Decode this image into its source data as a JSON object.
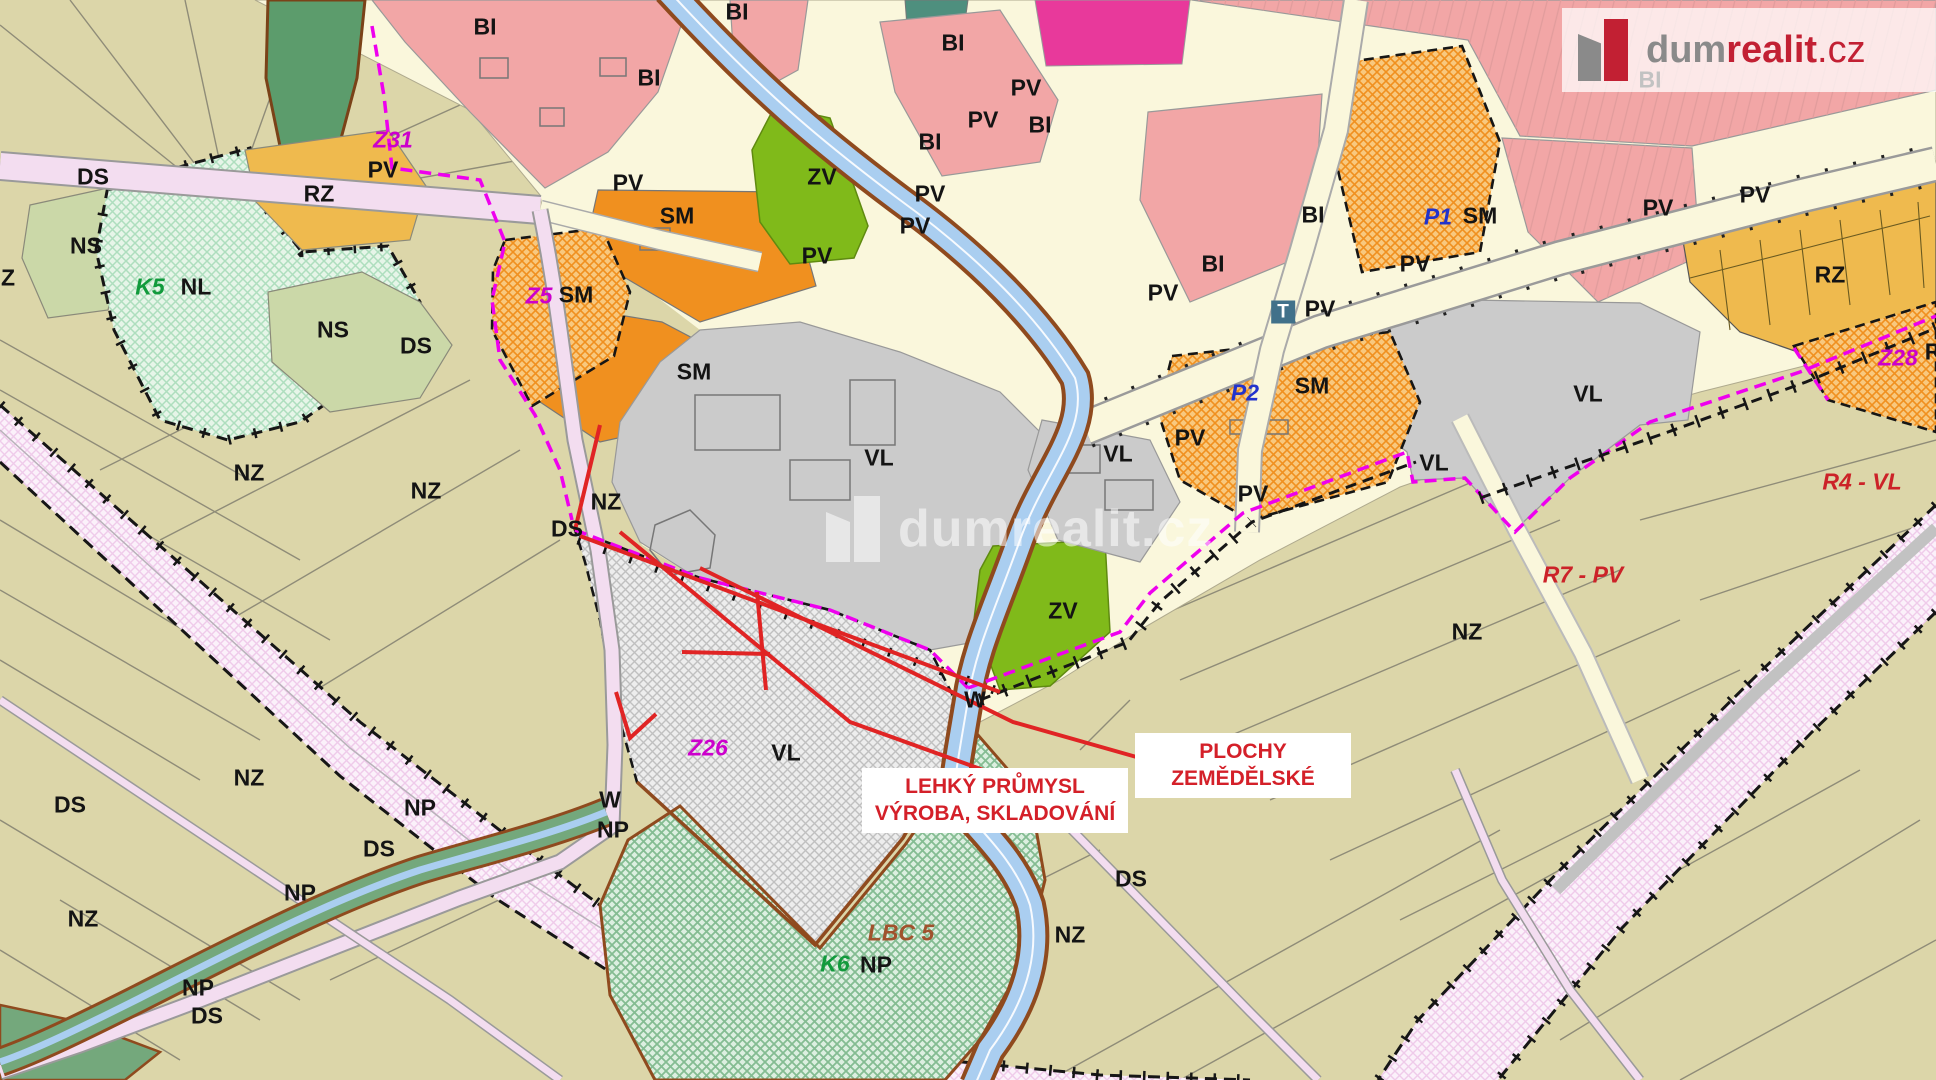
{
  "meta": {
    "title": "Územní plán - zoning map preview",
    "width": 1936,
    "height": 1080
  },
  "branding": {
    "logo_dum": "dum",
    "logo_realit": "realit",
    "logo_cz": ".cz",
    "watermark": "dumrealit.cz"
  },
  "annotations": {
    "industry": {
      "line1": "LEHKÝ PRŮMYSL",
      "line2": "VÝROBA, SKLADOVÁNÍ"
    },
    "agriculture": {
      "line1": "PLOCHY",
      "line2": "ZEMĚDĚLSKÉ"
    }
  },
  "colors": {
    "nz": "#DCD6A9",
    "cream": "#FAF7DC",
    "bi": "#F2A6A6",
    "magzone": "#E8399B",
    "sm": "#F0901F",
    "smhbg": "#F8C87E",
    "rz": "#EFBA4E",
    "zv": "#80BA1A",
    "vl": "#CBCBCB",
    "ns": "#CBD8A8",
    "np": "#74A87C",
    "dgreen": "#5C9C6C",
    "river": "#AACEF0",
    "bank": "#8F4A1E",
    "roadpink": "#F3DDF0",
    "dashm": "#EE00EE",
    "red": "#E02424",
    "redlabel": "#D42029",
    "brandgray": "#8A8A8A",
    "brandred": "#C22033"
  },
  "zone_labels": [
    {
      "t": "DS",
      "x": 93,
      "y": 177
    },
    {
      "t": "NS",
      "x": 86,
      "y": 246
    },
    {
      "t": "K5",
      "x": 150,
      "y": 287,
      "s": "g"
    },
    {
      "t": "NL",
      "x": 196,
      "y": 287
    },
    {
      "t": "RZ",
      "x": 319,
      "y": 194
    },
    {
      "t": "NS",
      "x": 333,
      "y": 330
    },
    {
      "t": "DS",
      "x": 416,
      "y": 346
    },
    {
      "t": "Z",
      "x": 8,
      "y": 278
    },
    {
      "t": "NZ",
      "x": 249,
      "y": 473
    },
    {
      "t": "NZ",
      "x": 426,
      "y": 491
    },
    {
      "t": "NZ",
      "x": 606,
      "y": 502
    },
    {
      "t": "DS",
      "x": 567,
      "y": 529
    },
    {
      "t": "Z31",
      "x": 393,
      "y": 140,
      "s": "m"
    },
    {
      "t": "PV",
      "x": 383,
      "y": 170
    },
    {
      "t": "PV",
      "x": 628,
      "y": 183
    },
    {
      "t": "SM",
      "x": 677,
      "y": 216
    },
    {
      "t": "Z5",
      "x": 539,
      "y": 296,
      "s": "m"
    },
    {
      "t": "SM",
      "x": 576,
      "y": 295
    },
    {
      "t": "SM",
      "x": 694,
      "y": 372
    },
    {
      "t": "ZV",
      "x": 822,
      "y": 177
    },
    {
      "t": "PV",
      "x": 817,
      "y": 256
    },
    {
      "t": "PV",
      "x": 930,
      "y": 194
    },
    {
      "t": "PV",
      "x": 915,
      "y": 226
    },
    {
      "t": "BI",
      "x": 485,
      "y": 27
    },
    {
      "t": "BI",
      "x": 649,
      "y": 78
    },
    {
      "t": "BI",
      "x": 737,
      "y": 12
    },
    {
      "t": "BI",
      "x": 953,
      "y": 43
    },
    {
      "t": "PV",
      "x": 1026,
      "y": 88
    },
    {
      "t": "PV",
      "x": 983,
      "y": 120
    },
    {
      "t": "BI",
      "x": 1040,
      "y": 125
    },
    {
      "t": "BI",
      "x": 930,
      "y": 142
    },
    {
      "t": "BI",
      "x": 1650,
      "y": 80
    },
    {
      "t": "BI",
      "x": 1313,
      "y": 215
    },
    {
      "t": "BI",
      "x": 1213,
      "y": 264
    },
    {
      "t": "PV",
      "x": 1163,
      "y": 293
    },
    {
      "t": "P1",
      "x": 1438,
      "y": 217,
      "s": "b"
    },
    {
      "t": "SM",
      "x": 1480,
      "y": 216
    },
    {
      "t": "PV",
      "x": 1415,
      "y": 264
    },
    {
      "t": "T",
      "x": 1283,
      "y": 312,
      "s": "t"
    },
    {
      "t": "PV",
      "x": 1320,
      "y": 309
    },
    {
      "t": "P2",
      "x": 1245,
      "y": 393,
      "s": "b"
    },
    {
      "t": "SM",
      "x": 1312,
      "y": 386
    },
    {
      "t": "PV",
      "x": 1190,
      "y": 438
    },
    {
      "t": "VL",
      "x": 879,
      "y": 458
    },
    {
      "t": "VL",
      "x": 1118,
      "y": 454
    },
    {
      "t": "VL",
      "x": 1588,
      "y": 394
    },
    {
      "t": "VL",
      "x": 1434,
      "y": 463
    },
    {
      "t": "PV",
      "x": 1253,
      "y": 494
    },
    {
      "t": "PV",
      "x": 1658,
      "y": 208
    },
    {
      "t": "PV",
      "x": 1755,
      "y": 195
    },
    {
      "t": "RZ",
      "x": 1830,
      "y": 275
    },
    {
      "t": "Z28",
      "x": 1898,
      "y": 358,
      "s": "m"
    },
    {
      "t": "R",
      "x": 1933,
      "y": 352
    },
    {
      "t": "R4 - VL",
      "x": 1862,
      "y": 482,
      "s": "r"
    },
    {
      "t": "R7 - PV",
      "x": 1583,
      "y": 575,
      "s": "r"
    },
    {
      "t": "NZ",
      "x": 1467,
      "y": 632
    },
    {
      "t": "Z26",
      "x": 708,
      "y": 748,
      "s": "m"
    },
    {
      "t": "VL",
      "x": 786,
      "y": 753
    },
    {
      "t": "W",
      "x": 975,
      "y": 700
    },
    {
      "t": "ZV",
      "x": 1063,
      "y": 611
    },
    {
      "t": "W",
      "x": 610,
      "y": 800
    },
    {
      "t": "NP",
      "x": 613,
      "y": 830
    },
    {
      "t": "NP",
      "x": 420,
      "y": 808
    },
    {
      "t": "DS",
      "x": 379,
      "y": 849
    },
    {
      "t": "NP",
      "x": 300,
      "y": 893
    },
    {
      "t": "NZ",
      "x": 249,
      "y": 778
    },
    {
      "t": "DS",
      "x": 70,
      "y": 805
    },
    {
      "t": "NZ",
      "x": 83,
      "y": 919
    },
    {
      "t": "NP",
      "x": 198,
      "y": 988
    },
    {
      "t": "DS",
      "x": 207,
      "y": 1016
    },
    {
      "t": "LBC 5",
      "x": 901,
      "y": 933,
      "s": "br"
    },
    {
      "t": "K6",
      "x": 835,
      "y": 964,
      "s": "g"
    },
    {
      "t": "NP",
      "x": 876,
      "y": 965
    },
    {
      "t": "NZ",
      "x": 1070,
      "y": 935
    },
    {
      "t": "DS",
      "x": 1131,
      "y": 879
    }
  ]
}
